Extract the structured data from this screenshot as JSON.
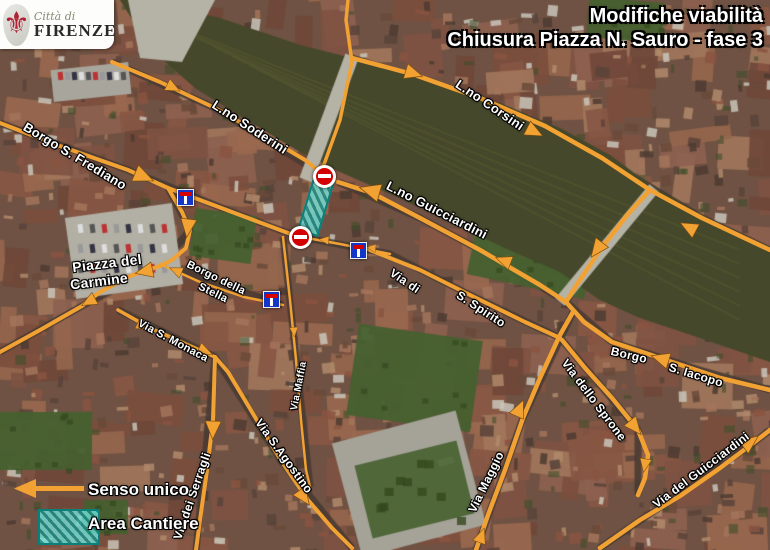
{
  "header": {
    "logo": {
      "fleur_icon": "⚜",
      "city_prefix": "Città di",
      "city_name": "FIRENZE"
    },
    "title_line1": "Modifiche viabilità",
    "title_line2": "Chiusura Piazza N. Sauro - fase 3"
  },
  "legend": {
    "one_way_label": "Senso unico",
    "work_area_label": "Area Cantiere"
  },
  "colors": {
    "route_orange": "#F2A133",
    "river_olive": "#45482a",
    "work_area_teal": "#3ecec6",
    "work_area_border": "#0b7f79",
    "no_entry_red": "#d40000",
    "dead_end_blue": "#1436c8"
  },
  "work_area": {
    "x": 316,
    "y": 206,
    "w": 22,
    "h": 58,
    "deg": 17
  },
  "street_labels": [
    {
      "text": "L.no Soderini",
      "x": 250,
      "y": 127,
      "deg": 33,
      "fs": 13
    },
    {
      "text": "Borgo S. Frediano",
      "x": 75,
      "y": 156,
      "deg": 31,
      "fs": 13
    },
    {
      "text": "L.no Corsini",
      "x": 490,
      "y": 105,
      "deg": 34,
      "fs": 13
    },
    {
      "text": "L.no Guicciardini",
      "x": 437,
      "y": 210,
      "deg": 27,
      "fs": 13
    },
    {
      "text": "Via di",
      "x": 405,
      "y": 281,
      "deg": 34,
      "fs": 12
    },
    {
      "text": "S. Spirito",
      "x": 481,
      "y": 309,
      "deg": 33,
      "fs": 12
    },
    {
      "text": "Piazza del",
      "x": 107,
      "y": 263,
      "deg": -7,
      "fs": 14
    },
    {
      "text": "Carmine",
      "x": 99,
      "y": 281,
      "deg": -7,
      "fs": 14
    },
    {
      "text": "Borgo della",
      "x": 216,
      "y": 278,
      "deg": 26,
      "fs": 11
    },
    {
      "text": "Stella",
      "x": 213,
      "y": 293,
      "deg": 26,
      "fs": 11
    },
    {
      "text": "Via S. Monaca",
      "x": 173,
      "y": 341,
      "deg": 28,
      "fs": 11
    },
    {
      "text": "Borgo",
      "x": 629,
      "y": 355,
      "deg": 13,
      "fs": 12
    },
    {
      "text": "S. Iacopo",
      "x": 696,
      "y": 375,
      "deg": 17,
      "fs": 12
    },
    {
      "text": "Via dello Sprone",
      "x": 594,
      "y": 400,
      "deg": 53,
      "fs": 12
    },
    {
      "text": "Via Maggio",
      "x": 486,
      "y": 482,
      "deg": -64,
      "fs": 12
    },
    {
      "text": "Via S.Agostino",
      "x": 284,
      "y": 456,
      "deg": 54,
      "fs": 12
    },
    {
      "text": "Via dei Serragli",
      "x": 192,
      "y": 496,
      "deg": -71,
      "fs": 12
    },
    {
      "text": "Via del Guicciardini",
      "x": 701,
      "y": 470,
      "deg": -37,
      "fs": 12
    },
    {
      "text": "Via Maffia",
      "x": 299,
      "y": 386,
      "deg": -79,
      "fs": 10
    }
  ],
  "signs": {
    "no_entry": [
      {
        "x": 324,
        "y": 176
      },
      {
        "x": 300,
        "y": 237
      }
    ],
    "dead_end": [
      {
        "x": 185,
        "y": 197
      },
      {
        "x": 271,
        "y": 299
      },
      {
        "x": 358,
        "y": 250
      }
    ]
  }
}
